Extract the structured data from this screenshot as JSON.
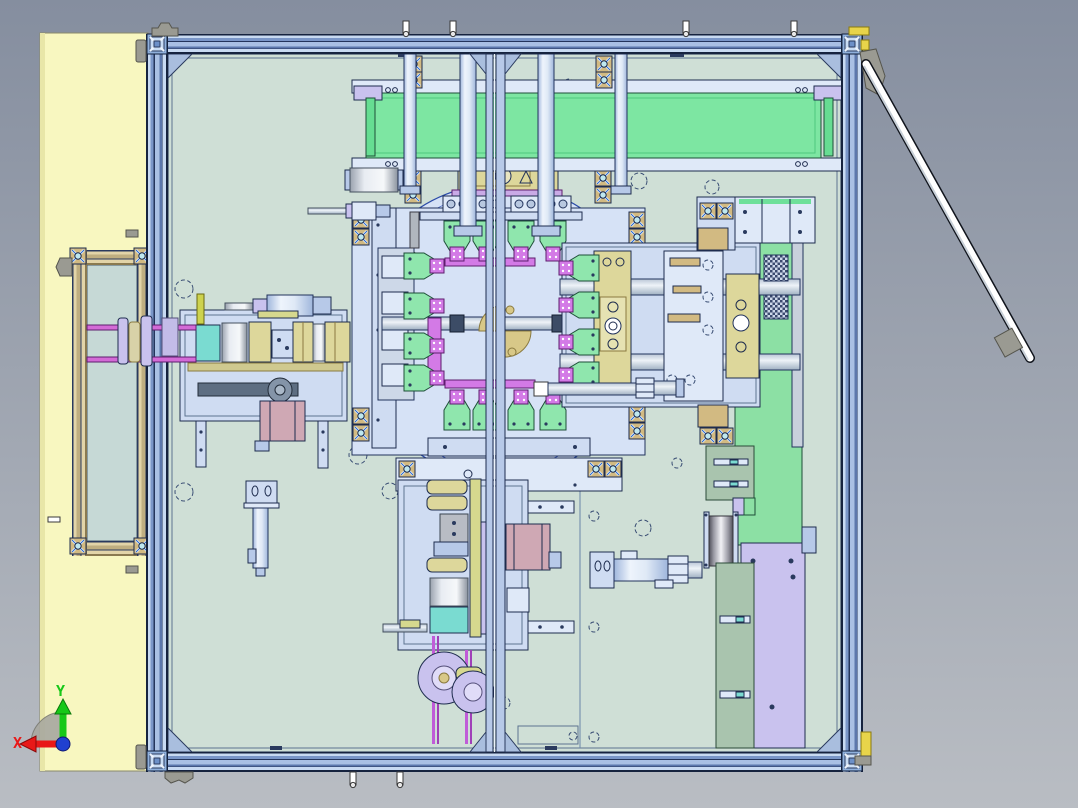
{
  "triad": {
    "icon": "coordinate-triad",
    "x_label": "X",
    "y_label": "Y"
  },
  "colors": {
    "background_top": "#858e9f",
    "background_bottom": "#b9bdc3",
    "panel_yellow": "#f8f7c0",
    "base_plate": "#cfdfd6",
    "outline": "#1e2c4e",
    "steel": "#cfdcf2",
    "turntable_blue": "#d6e2f6",
    "belt_green": "#7de6a2",
    "station_green": "#8fe6ad",
    "clamp_magenta": "#d37ae6",
    "block_tan": "#ddd79b",
    "extrusion_tan": "#d2ba82",
    "motor_pink": "#cfa8b4",
    "wheel_lavender": "#c9c2ee",
    "plate_sage": "#a9c4ae",
    "teal": "#7adbd1",
    "axis_x": "#e81818",
    "axis_y": "#18c818",
    "axis_z": "#2040d0",
    "rod_white": "#ffffff"
  }
}
